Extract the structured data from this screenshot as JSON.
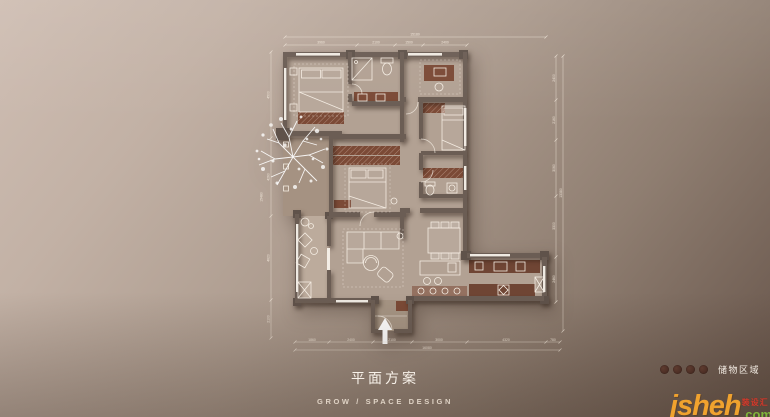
{
  "title": {
    "zh": "平面方案",
    "en": "GROW / SPACE DESIGN"
  },
  "legend": {
    "label": "储物区域",
    "dot_count": 4,
    "dot_color": "#4a2e25"
  },
  "watermark": {
    "name": "jsheh",
    "badge": "装设汇",
    "tld": ".com",
    "name_color": "#f0a22e",
    "badge_color": "#d23a2c",
    "tld_color": "#7fb53a"
  },
  "icons": {
    "tree": "plan-tree-canopy",
    "entrance_arrow": "up-arrow",
    "legend_dot": "filled-circle"
  },
  "colors": {
    "background_light": "#cfbeb3",
    "background_dark": "#665449",
    "wall": "#6b5d54",
    "floor": "#b2a193",
    "storage": "#7b4a36",
    "line_white": "#f6efe5"
  },
  "plan": {
    "dims": {
      "top": {
        "overall": "15180",
        "segs": [
          "3960",
          "2100",
          "1500",
          "2400"
        ]
      },
      "bottom": {
        "overall": "16080",
        "segs": [
          "1860",
          "2400",
          "2100",
          "3000",
          "4320",
          "780"
        ]
      },
      "left": {
        "overall": "15480",
        "segs": [
          "4500",
          "4260",
          "4620",
          "2100"
        ]
      },
      "right": {
        "overall": "13380",
        "segs": [
          "2400",
          "2160",
          "3060",
          "3300",
          "2460"
        ]
      }
    }
  }
}
